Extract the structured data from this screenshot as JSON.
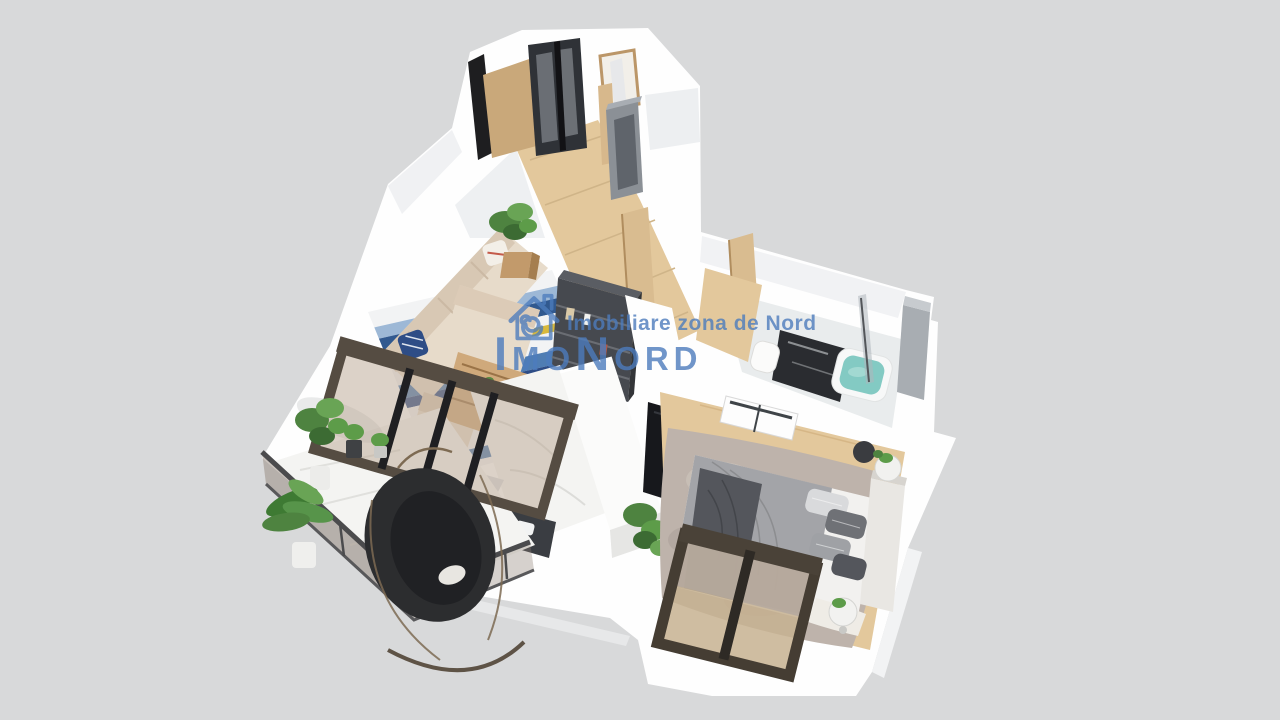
{
  "watermark": {
    "logo_icon": "house-spiral-logo",
    "tagline": "Imobiliare zona de Nord",
    "brand": "ImoNord"
  },
  "colors": {
    "background": "#d8d9da",
    "slab": "#fefefe",
    "watermark_blue": "#4d7cbd",
    "wood_floor": "#e3c89c",
    "door_wood": "#d9bc90",
    "marble": "#f4f4f2",
    "charcoal_unit": "#46494f",
    "window_frame_dark": "#4a4238",
    "glass_tint": "#8d7f72",
    "plant_green": "#55883f",
    "sofa_beige": "#e7dbca",
    "rug_blue": "#4f7db3",
    "rug_light_blue": "#9db8d6",
    "rug_navy": "#2e4d86",
    "rug_yellow": "#d8b93c",
    "bed_duvet_gray": "#a3a4a8",
    "bed_throw_dark": "#54565c",
    "fluffy_rug": "#beb3ab",
    "tub_water": "#83cac3",
    "tv_black": "#17181c",
    "console_wood": "#cfa97b",
    "steel_door_gray": "#8b9096"
  }
}
